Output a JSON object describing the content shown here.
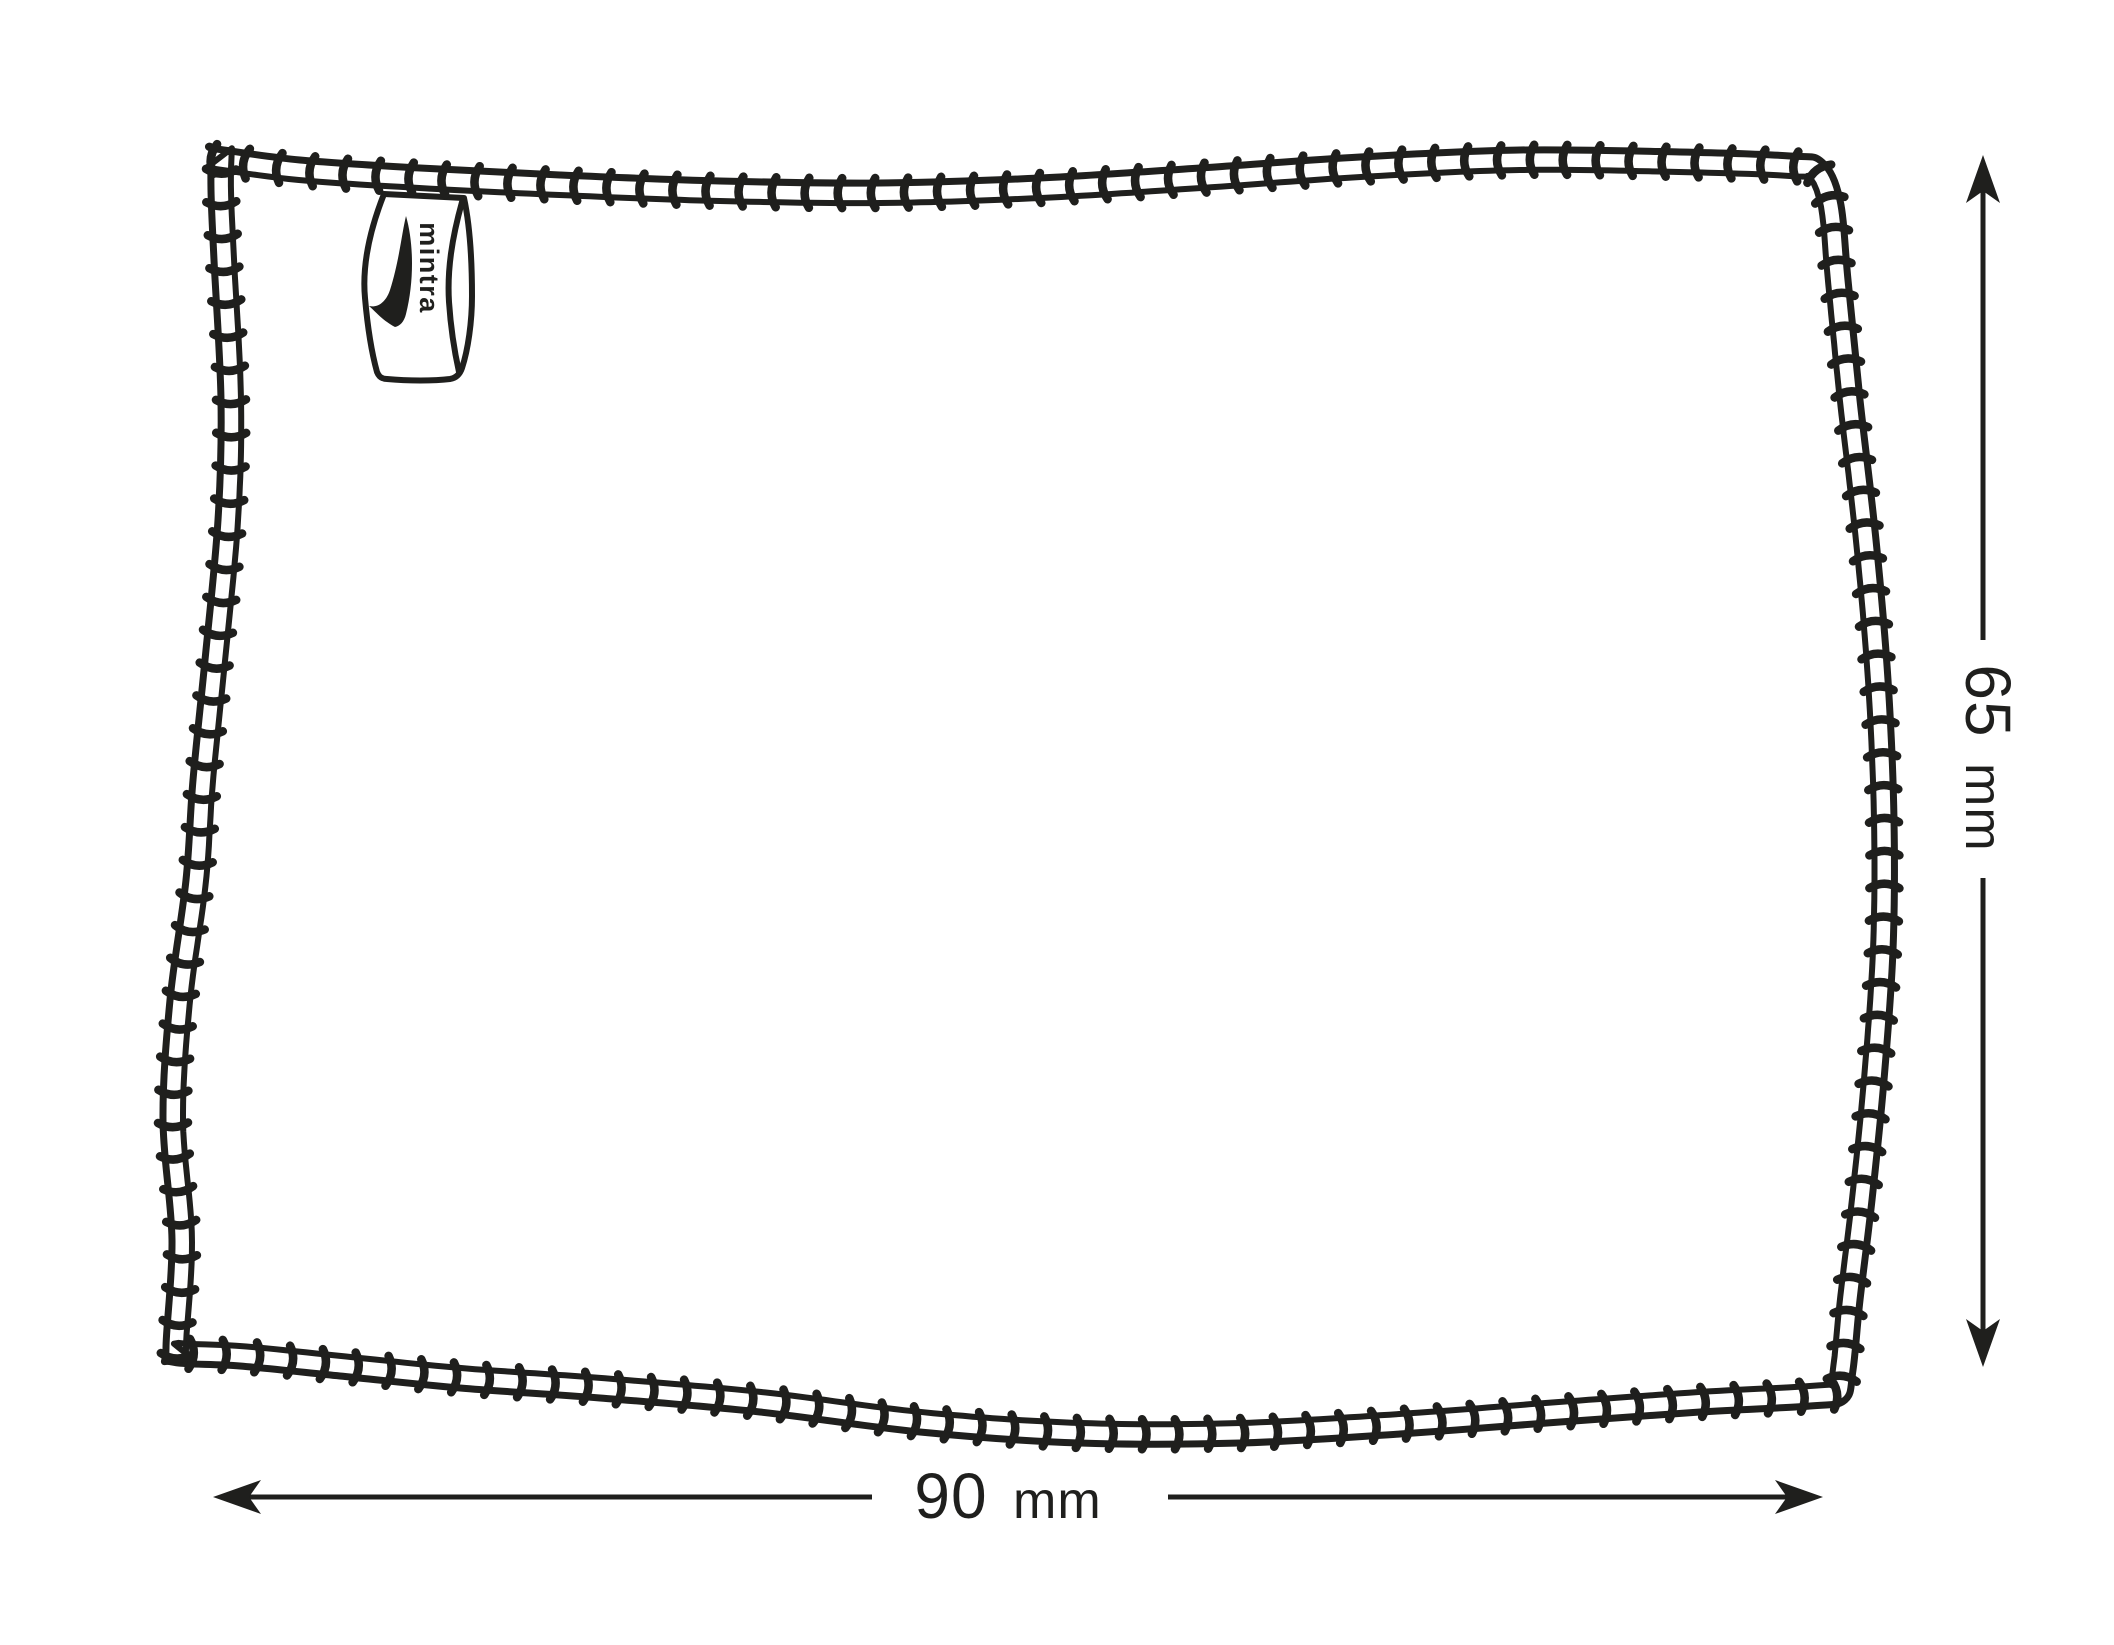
{
  "colors": {
    "ink": "#1f1f1d",
    "background": "#ffffff"
  },
  "tag": {
    "brand": "mintra",
    "logo_icon": "swoosh"
  },
  "dimensions": {
    "width": {
      "value": "90",
      "unit": "mm"
    },
    "height": {
      "value": "65",
      "unit": "mm"
    }
  }
}
